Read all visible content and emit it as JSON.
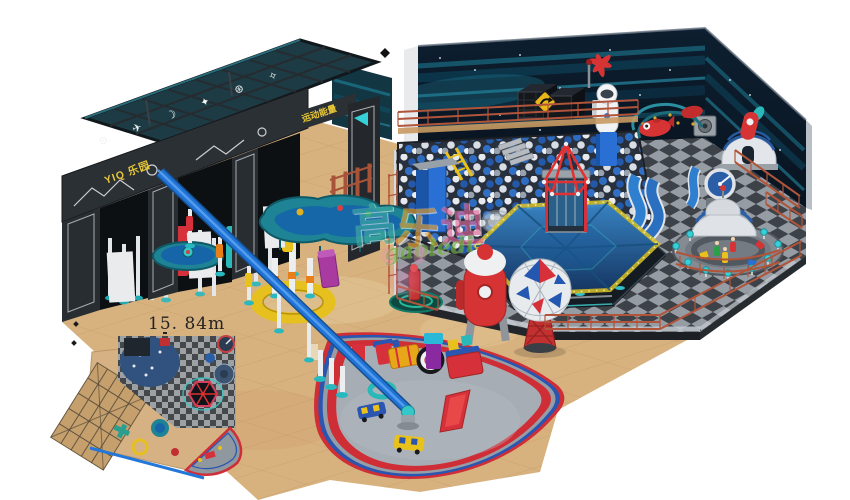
{
  "watermark": {
    "char_0": "高",
    "char_1": "乐",
    "char_2": "迪",
    "latin": "gaoledi"
  },
  "gate": {
    "sign_primary": "YIQ 乐园",
    "sign_secondary": "运动能量",
    "sign_color": "#e8c838",
    "icons": [
      {
        "name": "gear",
        "glyph": "⚙"
      },
      {
        "name": "plane",
        "glyph": "✈"
      },
      {
        "name": "moon",
        "glyph": "☽"
      },
      {
        "name": "star",
        "glyph": "✦"
      },
      {
        "name": "planet",
        "glyph": "⊛"
      },
      {
        "name": "spark",
        "glyph": "✧"
      }
    ]
  },
  "plan": {
    "dimension_label": "15. 84m"
  },
  "palette": {
    "wall_navy": "#0c1c2c",
    "wall_streak_teal": "#1d7a92",
    "floor_tan": "#d8b27e",
    "checker_dark": "#3d4248",
    "checker_light": "#969ca3",
    "fence_rust": "#b0543a",
    "rail_blue": "#2273d8",
    "ball_blue": "#2e6cc0",
    "ball_white": "#e6e9ee",
    "canopy_blue": "#2f86d8",
    "dome_white": "#e2e6ea",
    "dome_stripe": "#2a5fa8",
    "rocket_red": "#d63434",
    "fan_red": "#cf2e36",
    "fan_blue": "#2a55b0",
    "fan_grey": "#979da5",
    "accent_cyan": "#35d0d8",
    "accent_yellow": "#e8c11c"
  }
}
